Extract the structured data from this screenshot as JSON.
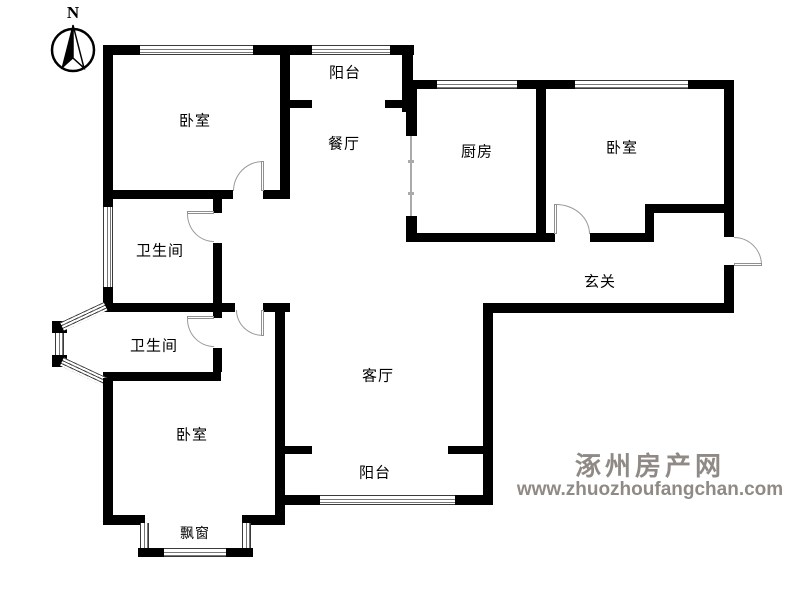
{
  "compass": {
    "label": "N"
  },
  "rooms": {
    "bedroom_top_left": {
      "label": "卧室"
    },
    "balcony_top": {
      "label": "阳台"
    },
    "dining_room": {
      "label": "餐厅"
    },
    "kitchen": {
      "label": "厨房"
    },
    "bedroom_top_right": {
      "label": "卧室"
    },
    "bathroom_upper": {
      "label": "卫生间"
    },
    "entry_hall": {
      "label": "玄关"
    },
    "bathroom_lower": {
      "label": "卫生间"
    },
    "living_room": {
      "label": "客厅"
    },
    "bedroom_bottom": {
      "label": "卧室"
    },
    "balcony_bottom": {
      "label": "阳台"
    },
    "bay_window": {
      "label": "飘窗"
    }
  },
  "watermark": {
    "site_name": "涿州房产网",
    "site_url": "www.zhuozhoufangchan.com",
    "color": "#8f8a86"
  },
  "colors": {
    "wall": "#000000",
    "door_arc": "#9a9a9a",
    "window_line": "#555555"
  }
}
